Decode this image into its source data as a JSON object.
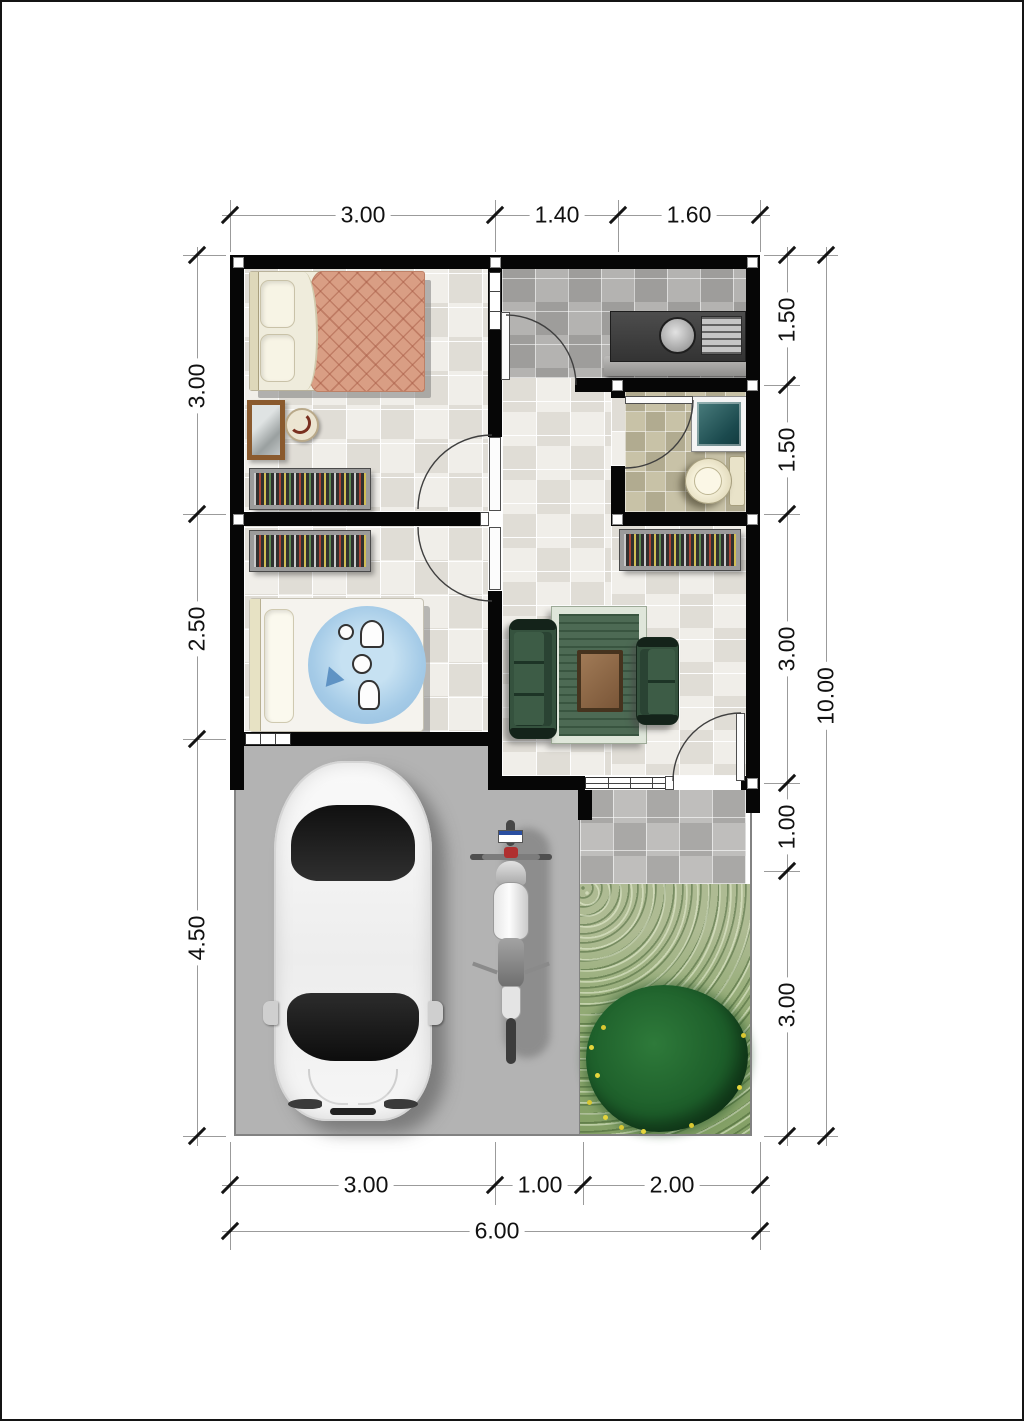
{
  "dimensions": {
    "top": [
      "3.00",
      "1.40",
      "1.60"
    ],
    "left": [
      "3.00",
      "2.50",
      "4.50"
    ],
    "right": [
      "1.50",
      "1.50",
      "3.00",
      "1.00",
      "3.00"
    ],
    "right_total": "10.00",
    "bottom": [
      "3.00",
      "1.00",
      "2.00"
    ],
    "bottom_total": "6.00"
  },
  "colors": {
    "wall": "#060606",
    "floor_light": "#e9e6e0",
    "floor_kitchen": "#a9a8a6",
    "floor_bathroom": "#bcb69b",
    "terrace": "#b5b4b2",
    "carport": "#b3b3b3",
    "grass": "#8fa873",
    "bush": "#1c5c29",
    "sofa_green": "#35523e",
    "bed_blanket_peach": "#d99e84",
    "bed_blanket_blue": "#a5cbe7",
    "water_basin_teal": "#1b4a4e",
    "counter": "#3e3e3e",
    "dimension_text": "#111111"
  }
}
